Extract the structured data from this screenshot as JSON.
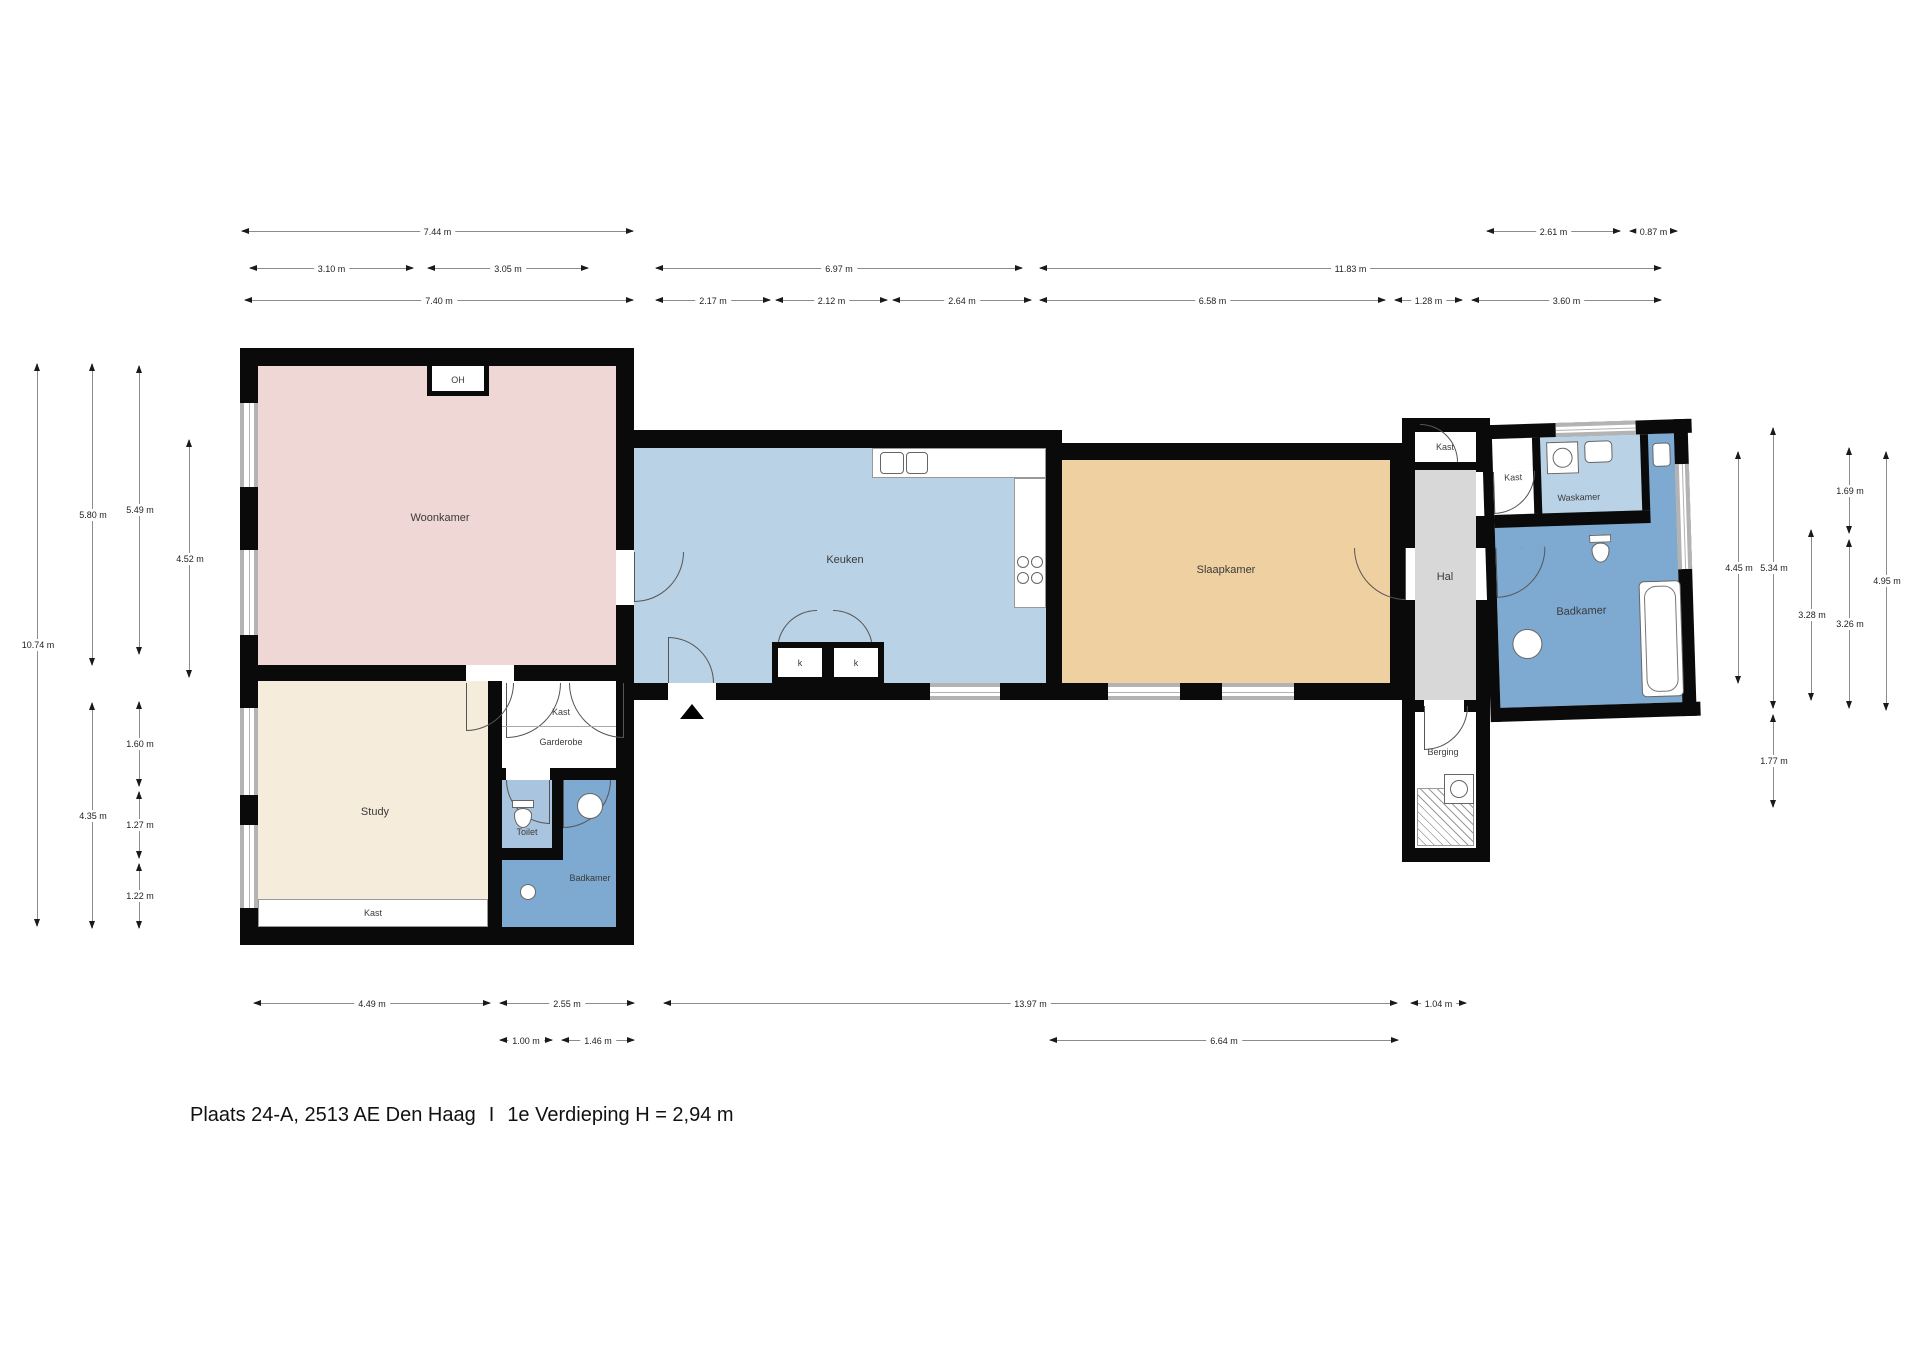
{
  "meta": {
    "address": "Plaats 24-A, 2513 AE Den Haag",
    "separator": "I",
    "floor_info": "1e Verdieping H = 2,94 m"
  },
  "rooms": {
    "woonkamer": "Woonkamer",
    "study": "Study",
    "keuken": "Keuken",
    "slaapkamer": "Slaapkamer",
    "hal": "Hal",
    "berging": "Berging",
    "waskamer": "Waskamer",
    "badkamer_left": "Badkamer",
    "badkamer_right": "Badkamer",
    "toilet": "Toilet",
    "garderobe": "Garderobe",
    "kast_garderobe": "Kast",
    "kast_study": "Kast",
    "kast_hal": "Kast",
    "kast_waskamer": "Kast",
    "oh": "OH",
    "k1": "k",
    "k2": "k"
  },
  "dimensions": {
    "top": {
      "d744": "7.44 m",
      "d261": "2.61 m",
      "d087": "0.87 m",
      "d310": "3.10 m",
      "d305": "3.05 m",
      "d697": "6.97 m",
      "d1183": "11.83 m",
      "d740": "7.40 m",
      "d217": "2.17 m",
      "d212": "2.12 m",
      "d264": "2.64 m",
      "d658": "6.58 m",
      "d128": "1.28 m",
      "d360": "3.60 m"
    },
    "bottom": {
      "d449": "4.49 m",
      "d255": "2.55 m",
      "d1397": "13.97 m",
      "d104": "1.04 m",
      "d100": "1.00 m",
      "d146": "1.46 m",
      "d664": "6.64 m"
    },
    "left": {
      "d1074": "10.74 m",
      "d580": "5.80 m",
      "d435": "4.35 m",
      "d549": "5.49 m",
      "d160": "1.60 m",
      "d127": "1.27 m",
      "d122": "1.22 m",
      "d452": "4.52 m"
    },
    "right": {
      "d445": "4.45 m",
      "d534": "5.34 m",
      "d177": "1.77 m",
      "d328": "3.28 m",
      "d169": "1.69 m",
      "d326": "3.26 m",
      "d495": "4.95 m"
    }
  },
  "colors": {
    "woonkamer": "#eed7d5",
    "study": "#f5ecdc",
    "keuken": "#b9d2e6",
    "slaapkamer": "#efd0a1",
    "badkamer": "#7ea9d1",
    "toilet": "#a9c4de",
    "hal": "#d8d8d8",
    "wall": "#0a0a0a",
    "window": "#b3b3b3",
    "dim_line": "#8c8c8c",
    "dim_text": "#222222"
  }
}
